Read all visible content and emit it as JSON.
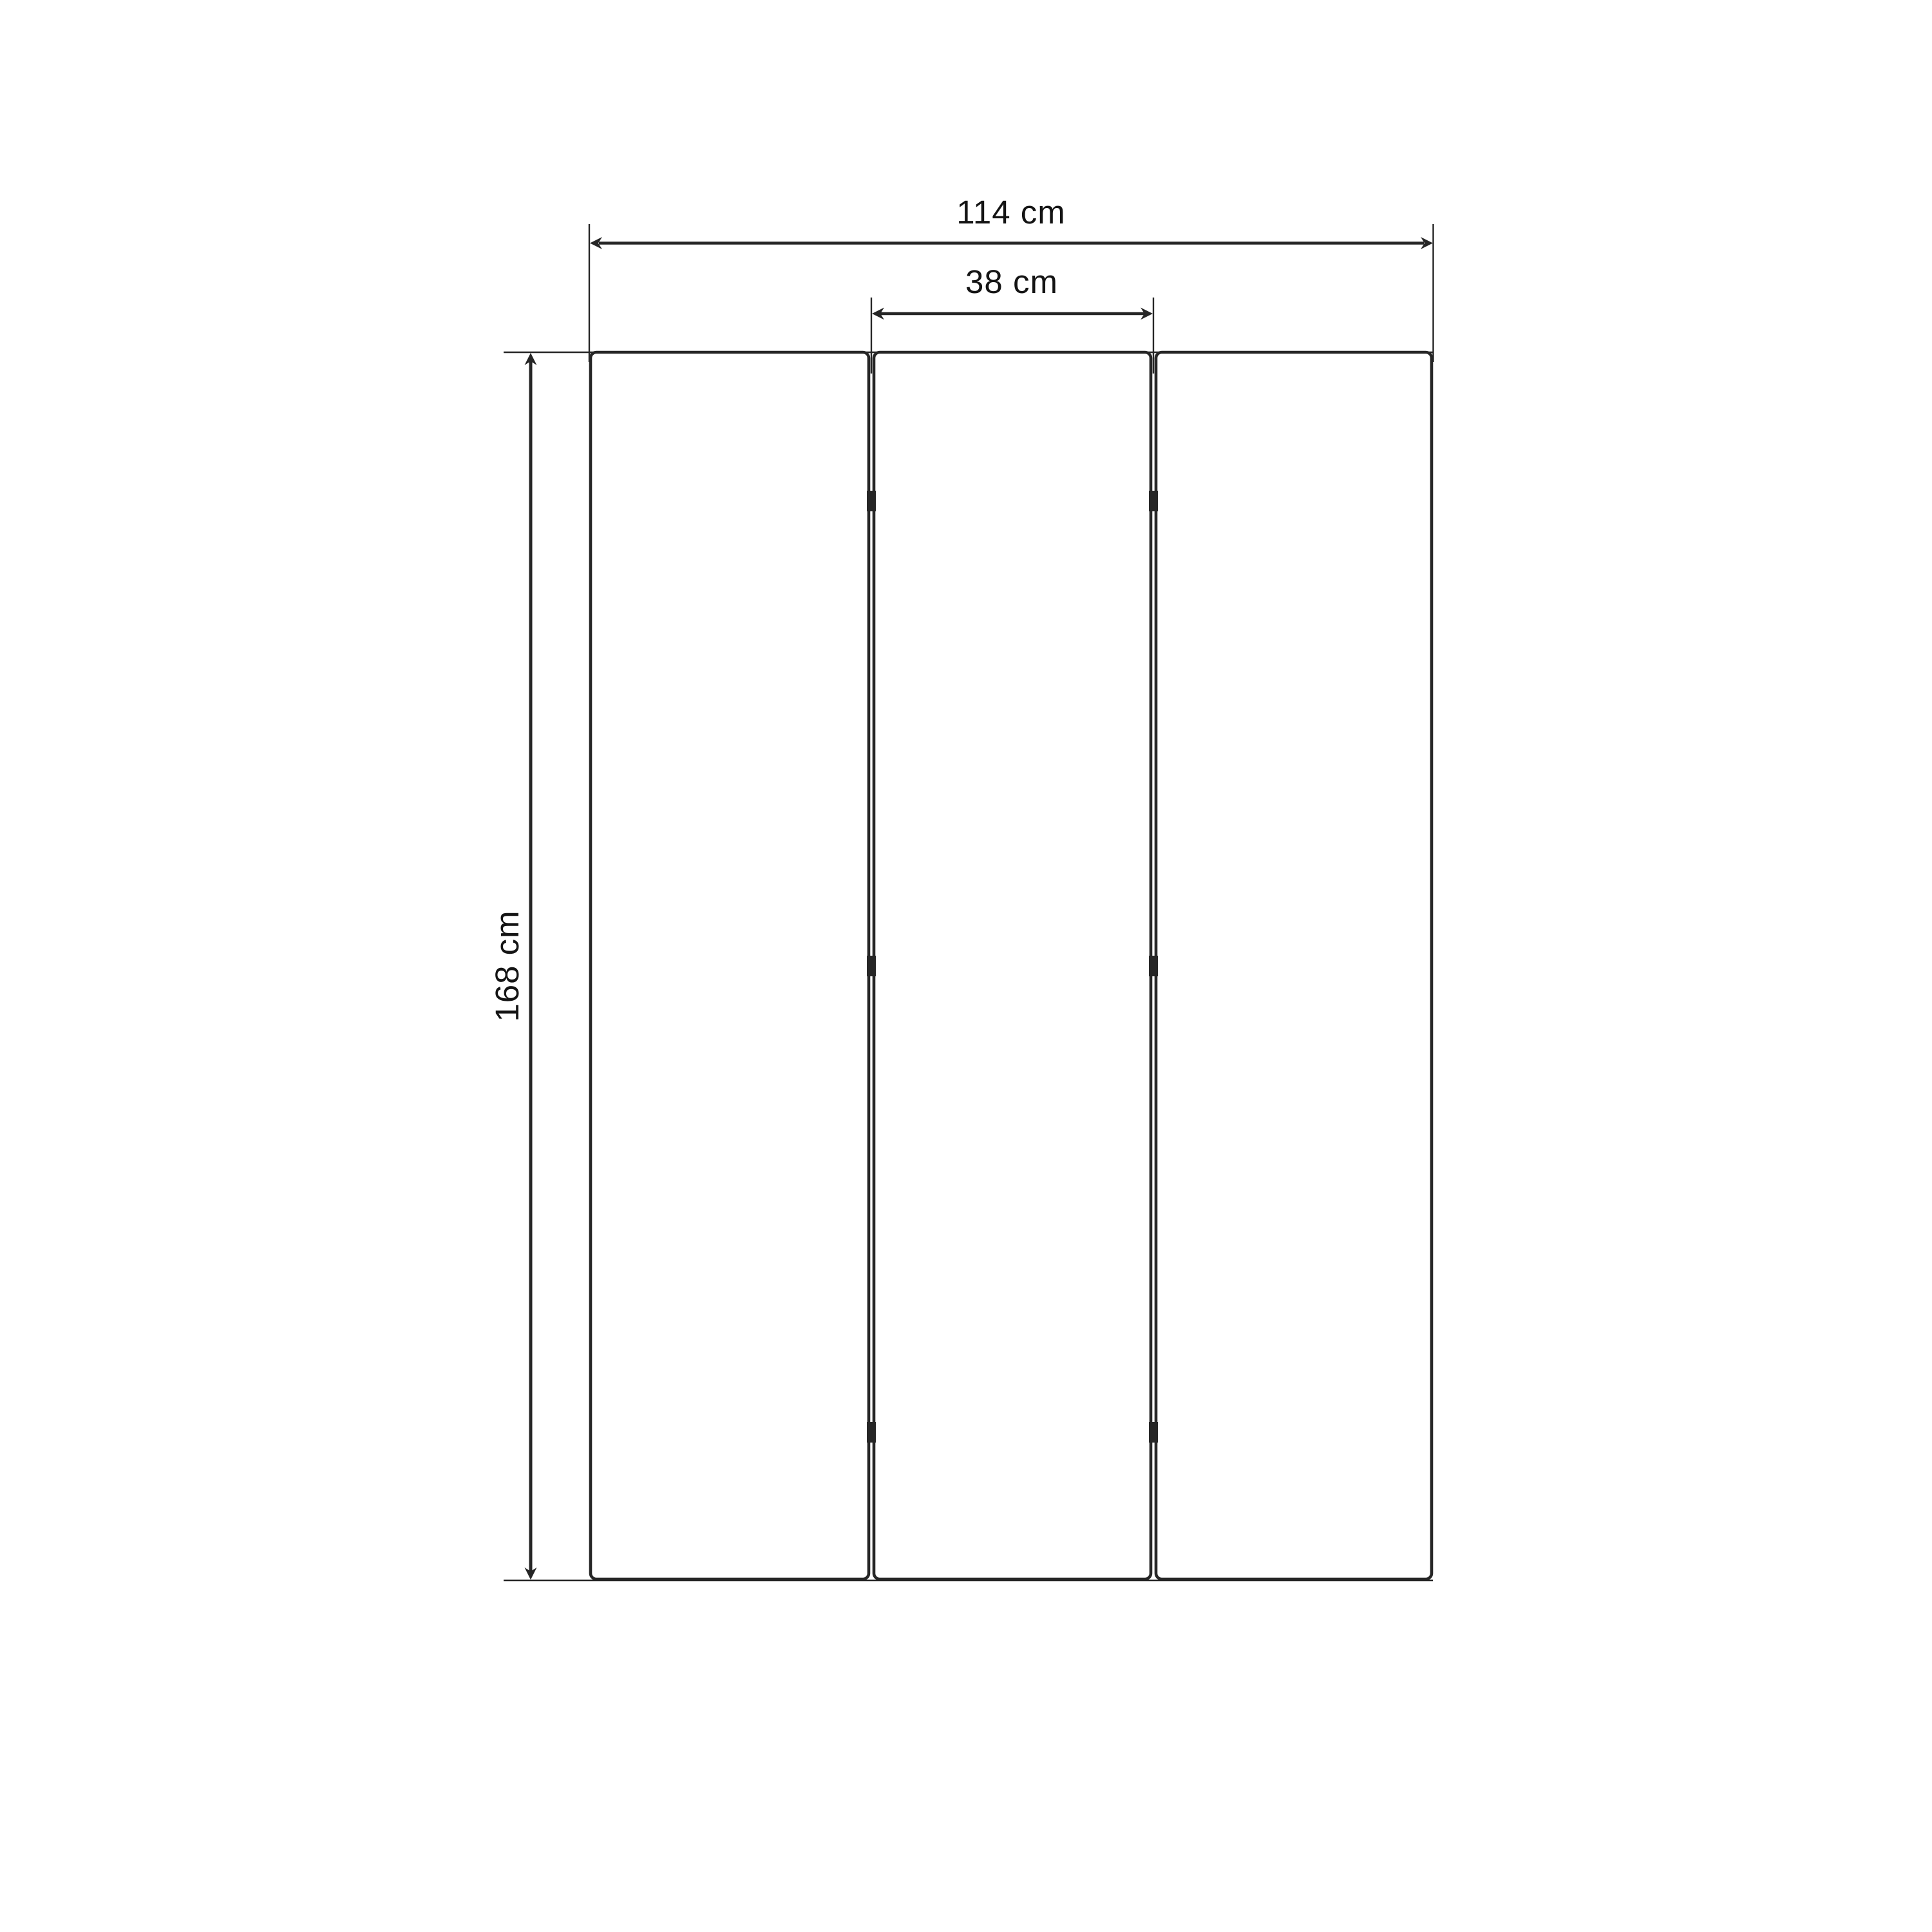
{
  "diagram": {
    "type": "furniture dimension drawing",
    "subject": "three-panel folding screen, front elevation",
    "panel_count": 3,
    "hinge_marks_per_gap": 3,
    "labels": {
      "total_width": "114 cm",
      "panel_width": "38 cm",
      "height": "168 cm"
    }
  },
  "colors": {
    "ink": "#262626",
    "text": "#141414",
    "background": "#ffffff"
  }
}
